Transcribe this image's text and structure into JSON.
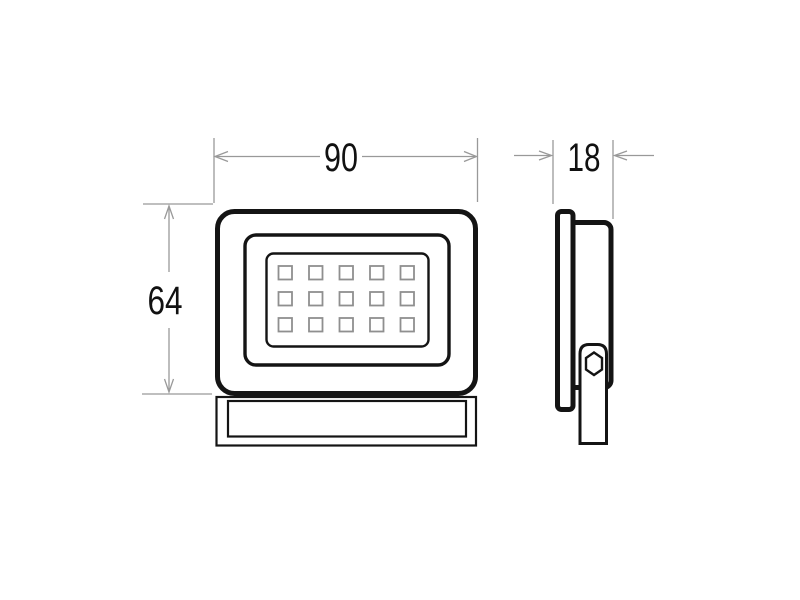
{
  "drawing": {
    "dimensions": {
      "width": "90",
      "height": "64",
      "depth": "18"
    },
    "led_grid": {
      "rows": 3,
      "cols": 5
    },
    "colors": {
      "outline": "#141414",
      "dimension_line": "#999999",
      "led_outline": "#8f8f8f",
      "text": "#111111",
      "background": "#ffffff"
    }
  }
}
